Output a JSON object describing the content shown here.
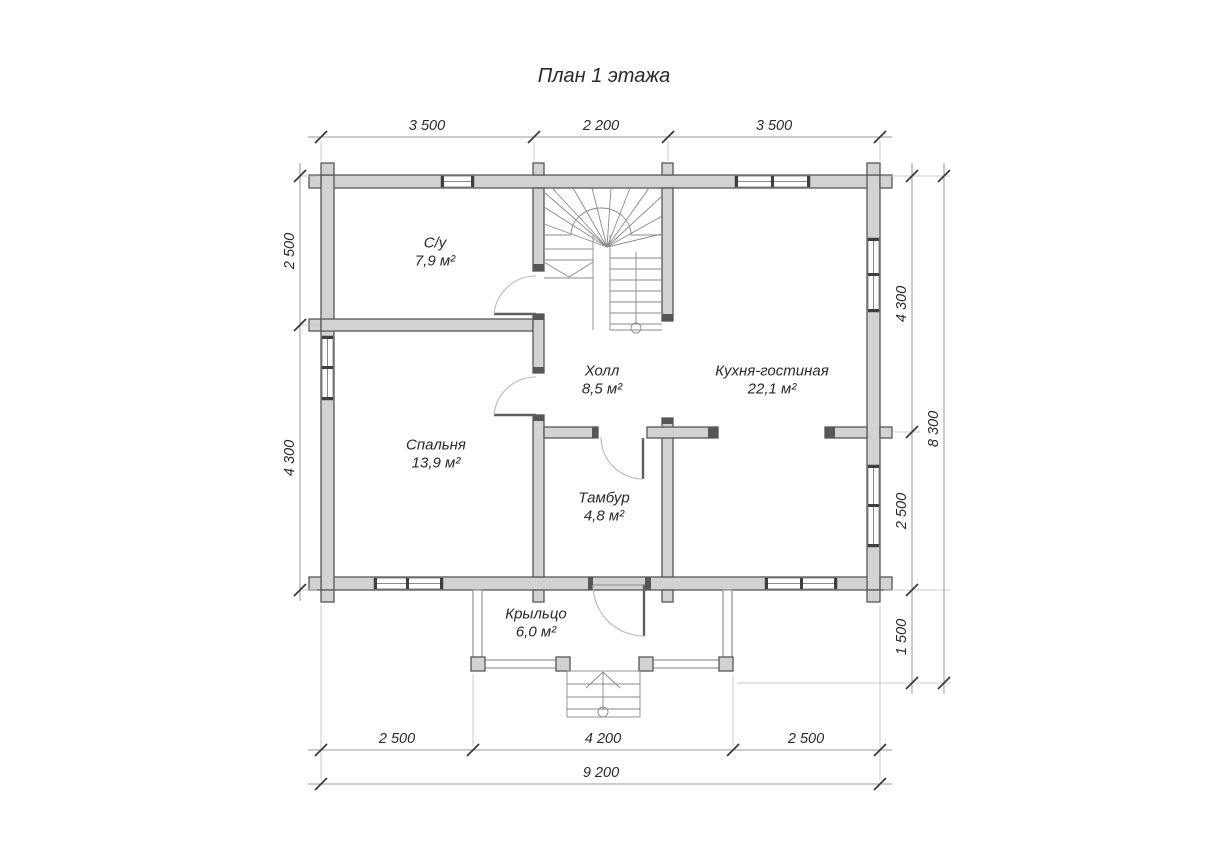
{
  "title": "План 1 этажа",
  "rooms": [
    {
      "name": "С/у",
      "area": "7,9 м²"
    },
    {
      "name": "Холл",
      "area": "8,5 м²"
    },
    {
      "name": "Кухня-гостиная",
      "area": "22,1 м²"
    },
    {
      "name": "Спальня",
      "area": "13,9 м²"
    },
    {
      "name": "Тамбур",
      "area": "4,8 м²"
    },
    {
      "name": "Крыльцо",
      "area": "6,0 м²"
    }
  ],
  "dimensions": {
    "top": [
      "3 500",
      "2 200",
      "3 500"
    ],
    "left": [
      "2 500",
      "4 300"
    ],
    "right": [
      "4 300",
      "2 500",
      "1 500"
    ],
    "right_total": "8 300",
    "bottom": [
      "2 500",
      "4 200",
      "2 500"
    ],
    "bottom_total": "9 200"
  },
  "colors": {
    "wall_fill": "#d2d2d2",
    "wall_stroke": "#575757",
    "dim_line": "#9a9a9a",
    "thin_line": "#8a8a8a",
    "text": "#2a2a2a"
  }
}
